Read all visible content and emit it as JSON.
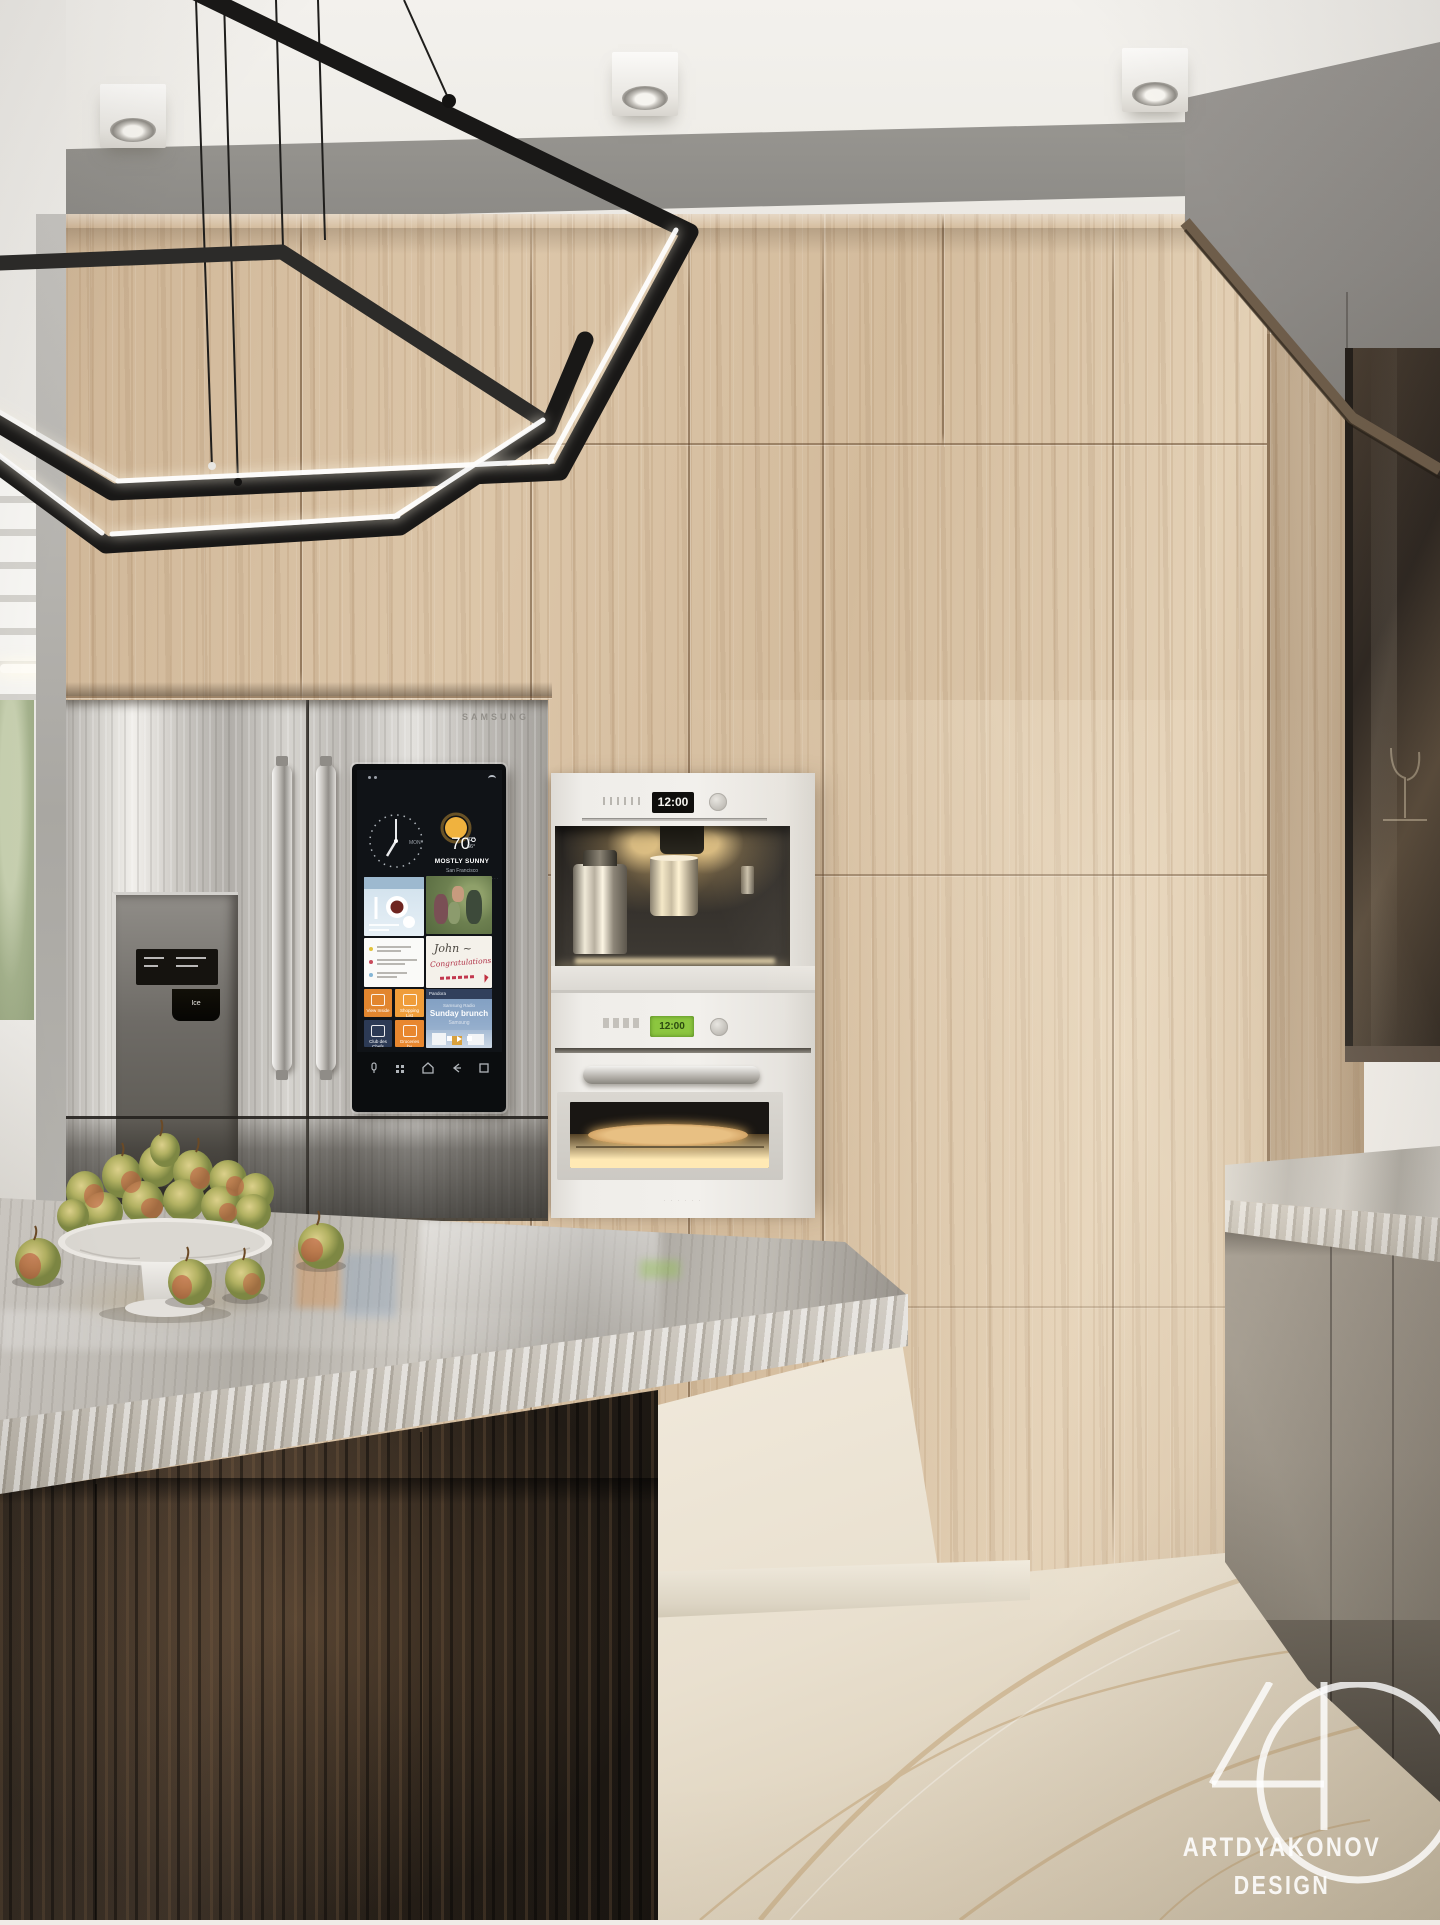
{
  "watermark": {
    "monogram": "AD",
    "line1": "ARTDYAKONOV",
    "line2": "DESIGN"
  },
  "fridge": {
    "brand": "SAMSUNG",
    "dispenser": {
      "ice_label": "Ice"
    },
    "screen": {
      "clock": {
        "day": "MON"
      },
      "weather": {
        "temp": "70°",
        "high": "82°",
        "low": "66°",
        "condition": "MOSTLY SUNNY",
        "location": "San Francisco"
      },
      "note": {
        "line1": "John ~",
        "line2": "Congratulations!"
      },
      "music": {
        "app": "Pandora",
        "station": "Samsung Radio",
        "title": "Sunday brunch",
        "artist": "Samsung"
      },
      "apps": [
        {
          "label": "View Inside"
        },
        {
          "label": "Shopping List"
        },
        {
          "label": "Club des Chefs"
        },
        {
          "label": "Groceries by MasterCard"
        }
      ],
      "agenda": {
        "dot_colors": [
          "#e2c33c",
          "#c84a5b",
          "#85b6d6"
        ]
      }
    }
  },
  "appliances": {
    "coffee_machine": {
      "display_time": "12:00"
    },
    "oven": {
      "display_time": "12:00"
    }
  },
  "palette": {
    "wood": "#d6bf9f",
    "ceiling": "#f3f1ed",
    "soffit_grey": "#96948f",
    "stainless": "#c9c6c1",
    "island_wood": "#2a221b",
    "marble_counter": "#b8b4ad",
    "marble_floor": "#e9e0cf",
    "accent_orange": "#e8872f",
    "accent_navy": "#2c3a55",
    "accent_blue": "#7d9cc0",
    "oven_display_green": "#8cc63f"
  }
}
